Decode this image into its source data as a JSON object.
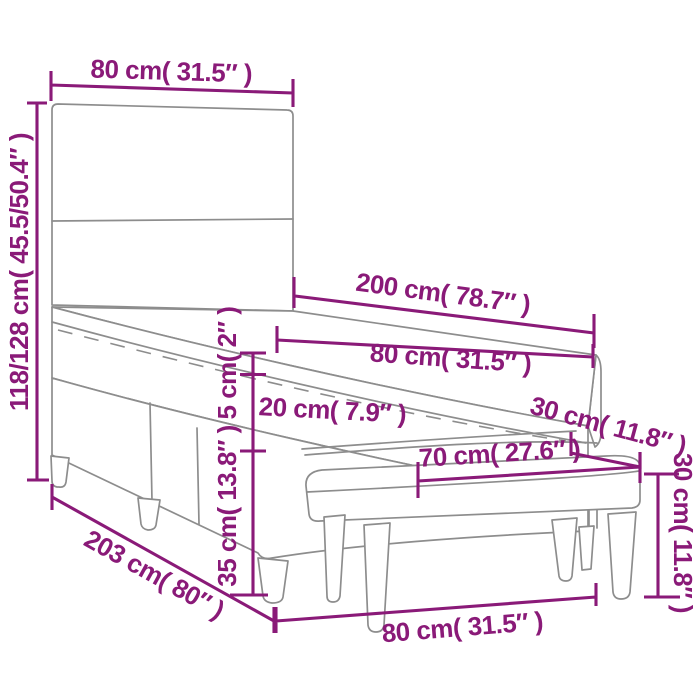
{
  "diagram": {
    "kind": "product-dimension-diagram",
    "subject": "box spring bed with headboard, pillow-top mattress and upholstered bench",
    "background": "#ffffff"
  },
  "colors": {
    "accent": "#8a1a78",
    "line_art": "#8d8d8d"
  },
  "dimensions": [
    {
      "id": "headboard-width",
      "label": "80 cm( 31.5″ )"
    },
    {
      "id": "overall-height",
      "label": "118/128 cm( 45.5/50.4″ )"
    },
    {
      "id": "bed-length",
      "label": "200 cm( 78.7″ )"
    },
    {
      "id": "mattress-width",
      "label": "80 cm( 31.5″ )"
    },
    {
      "id": "topper-height",
      "label": "5 cm( 2″ )"
    },
    {
      "id": "mattress-height",
      "label": "20 cm( 7.9″ )"
    },
    {
      "id": "bench-depth",
      "label": "30 cm( 11.8″ )"
    },
    {
      "id": "bench-seat-width",
      "label": "70 cm( 27.6″ )"
    },
    {
      "id": "base-height",
      "label": "35 cm( 13.8″ )"
    },
    {
      "id": "total-length",
      "label": "203 cm( 80″ )"
    },
    {
      "id": "bench-width",
      "label": "80 cm( 31.5″ )"
    },
    {
      "id": "bench-height",
      "label": "30 cm( 11.8″ )"
    }
  ]
}
